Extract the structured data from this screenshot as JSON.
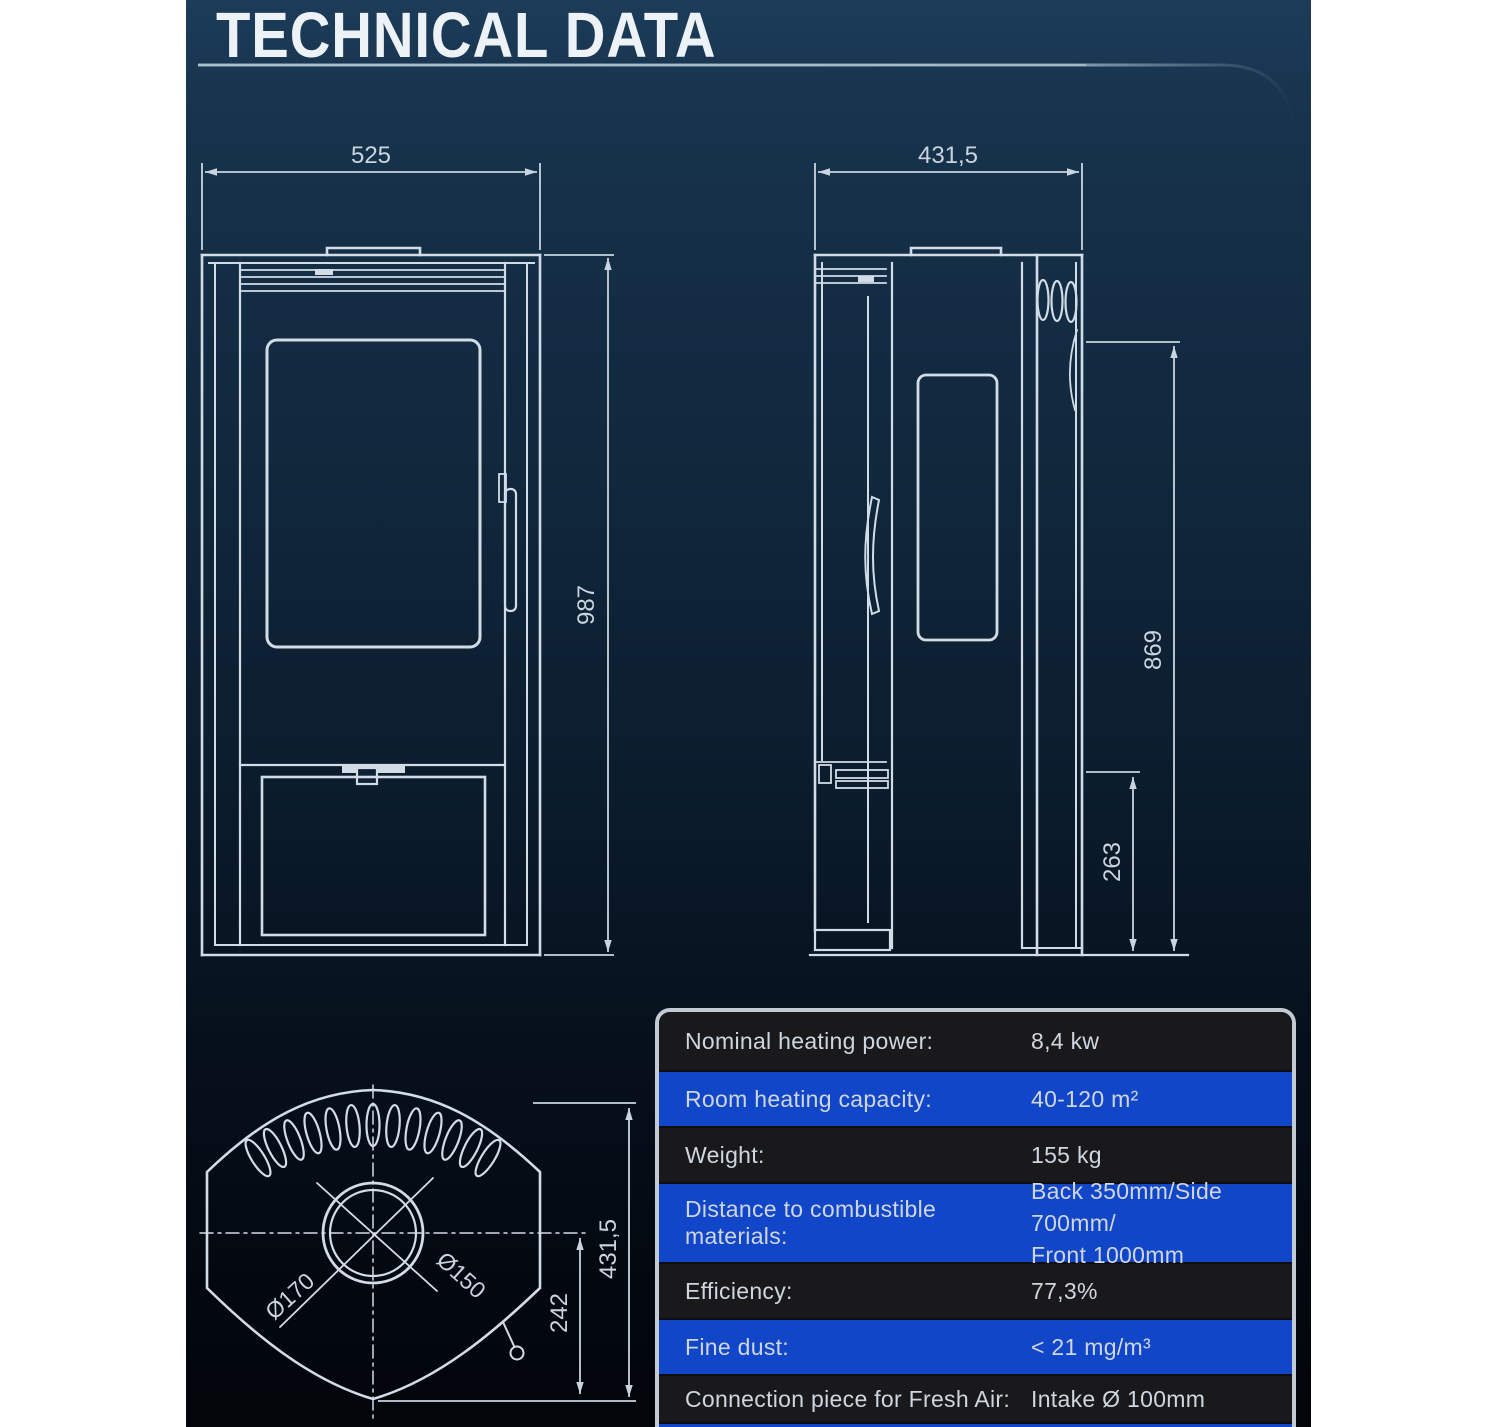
{
  "page": {
    "title": "TECHNICAL DATA"
  },
  "colors": {
    "margin_white": "#ffffff",
    "background_top": "#1c3c59",
    "background_bottom": "#02050a",
    "drawing_line": "#d2dce6",
    "dimension_text": "#c9d4df",
    "table_row_dark": "#19191b",
    "table_row_blue": "#1246c8",
    "table_border": "#c2cad3",
    "table_text": "#ced6df",
    "title_text": "#edf2f7"
  },
  "front_view": {
    "width_label": "525",
    "height_label": "987"
  },
  "side_view": {
    "depth_label": "431,5",
    "height_label": "869",
    "intake_label": "263"
  },
  "top_view": {
    "outer_dia_label": "Ø170",
    "inner_dia_label": "Ø150",
    "offset_label": "242",
    "depth_label": "431,5"
  },
  "spec_table": {
    "rows": [
      {
        "label": "Nominal heating power:",
        "value": "8,4 kw"
      },
      {
        "label": "Room heating capacity:",
        "value": "40-120 m²"
      },
      {
        "label": "Weight:",
        "value": "155 kg"
      },
      {
        "label": "Distance to combustible materials:",
        "value": "Back 350mm/Side 700mm/\nFront 1000mm"
      },
      {
        "label": "Efficiency:",
        "value": "77,3%"
      },
      {
        "label": "Fine dust:",
        "value": "< 21 mg/m³"
      },
      {
        "label": "Connection piece for Fresh Air:",
        "value": "Intake Ø 100mm"
      }
    ]
  }
}
